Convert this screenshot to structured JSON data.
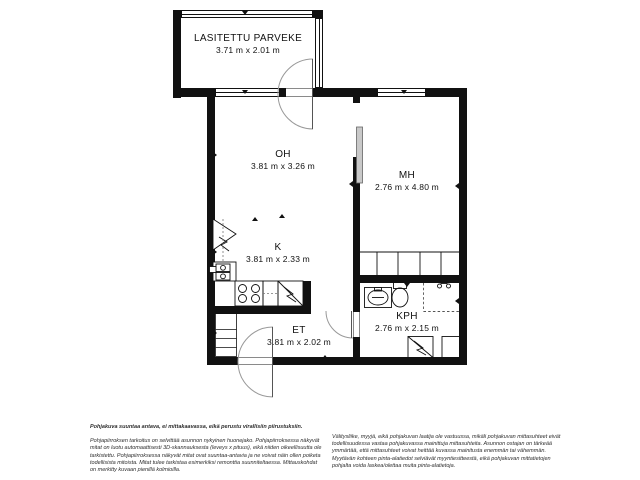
{
  "colors": {
    "wall": "#111111",
    "background": "#ffffff",
    "door_arc": "#999999",
    "sliding_door_fill": "#c9c9c9",
    "room_text": "#111111",
    "disclaimer_text": "#2e2e2e"
  },
  "rooms": {
    "balcony": {
      "name": "LASITETTU PARVEKE",
      "dimensions": "3.71 m x 2.01 m"
    },
    "living_room": {
      "name": "OH",
      "dimensions": "3.81 m x 3.26 m"
    },
    "bedroom": {
      "name": "MH",
      "dimensions": "2.76 m x 4.80 m"
    },
    "kitchen": {
      "name": "K",
      "dimensions": "3.81 m x 2.33 m"
    },
    "entrance": {
      "name": "ET",
      "dimensions": "3.81 m x 2.02 m"
    },
    "bathroom": {
      "name": "KPH",
      "dimensions": "2.76 m x 2.15 m"
    }
  },
  "fixtures": [
    "glazed-balcony-windows",
    "balcony-door-swing",
    "front-door-swing",
    "bathroom-door-swing",
    "bedroom-sliding-door",
    "bedroom-wardrobe",
    "kitchen-refrigerator",
    "kitchen-oven-unit",
    "kitchen-stove",
    "kitchen-dishwasher",
    "entrance-closet",
    "bathroom-sink",
    "toilet",
    "shower-area",
    "washing-machine",
    "bathroom-cabinet",
    "measurement-triangles"
  ],
  "disclaimer": {
    "heading": "Pohjakuva suuntaa antava, ei mittakaavassa, eikä perustu virallisiin piirustuksiin.",
    "left_paragraph": "Pohjapiirroksen tarkoitus on selvittää asunnon nykyinen huonejako. Pohjapiirroksessa näkyvät mitat on luotu automaattisesti 3D-skannauksesta (leveys x pituus), eikä niiden oikeellisuutta ole tarkistettu. Pohjapiirroksessa näkyvät mitat ovat suuntaa-antavia ja ne voivat näin ollen poiketa todellisista mitoista. Mitat tulee tarkistaa esimerkiksi remonttia suunniteltaessa. Mittauskohdat on merkitty kuvaan pienillä kolmioilla.",
    "right_paragraph": "Välitysliike, myyjä, eikä pohjakuvan laatija ole vastuussa, mikäli pohjakuvan mittasuhteet eivät todellisuudessa vastaa pohjakuvassa mainittuja mittasuhteita. Asunnon ostajan on tärkeää ymmärtää, että mittasuhteet voivat heittää kuvassa mainitusta enemmän tai vähemmän. Myytävän kohteen pinta-alatiedot selviävät myyntiesitteestä, eikä pohjakuvan mittatietojen pohjalta voida laskea/olettaa muita pinta-alatietoja."
  }
}
